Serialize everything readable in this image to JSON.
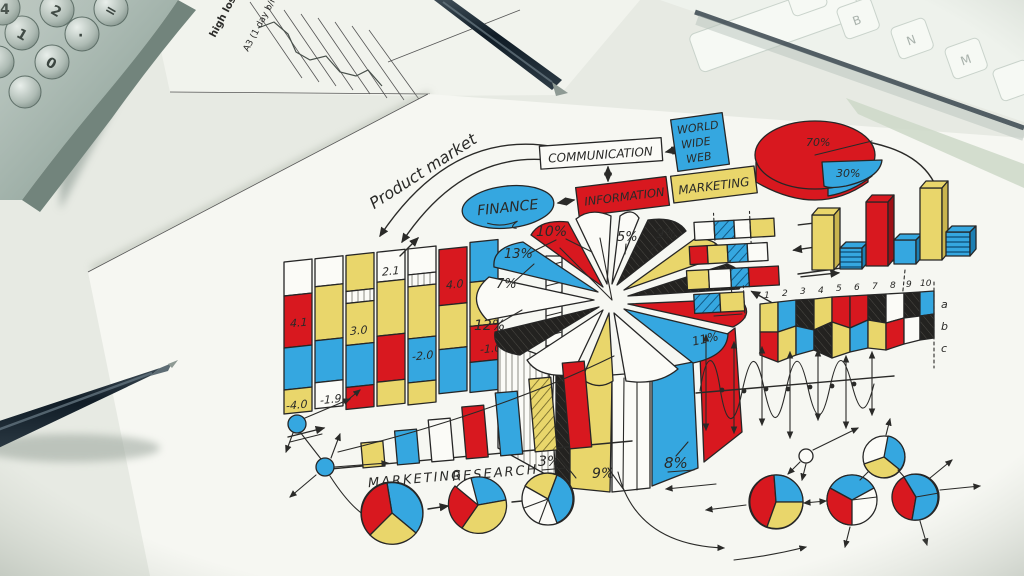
{
  "palette": {
    "red": "#d8181f",
    "blue": "#35a7e0",
    "yellow": "#e9d66b",
    "ink": "#2a2a28",
    "paper": "#f6f7f2"
  },
  "calculator": {
    "keys": [
      "0",
      "1",
      "2",
      "·",
      "=",
      "4"
    ]
  },
  "printed_sheet": {
    "note1": "high loss.",
    "note2": "A3 (1 day b/m)"
  },
  "keyboard": {
    "keys": [
      "B",
      "N",
      "M"
    ]
  },
  "flowchart": {
    "product_market": "Product market",
    "communication": "COMMUNICATION",
    "www_line1": "WORLD",
    "www_line2": "WIDE",
    "www_line3": "WEB",
    "finance": "FINANCE",
    "information": "INFORMATION",
    "marketing": "MARKETING"
  },
  "pie_3d_small": {
    "label_top": "70%",
    "label_bottom": "30%"
  },
  "big_pie": {
    "labels": [
      "10%",
      "5%",
      "9%",
      "7%",
      "6%",
      "11%",
      "8%",
      "9%",
      "3%",
      "12%",
      "7%",
      "13%"
    ]
  },
  "ribbon_chart": {
    "values": [
      "4.1",
      "2.1",
      "4.0",
      "3.0",
      "-2.0",
      "-1.0",
      "-4.0",
      "-1.9"
    ]
  },
  "mosaic_chart": {
    "ticks": [
      "1",
      "2",
      "3",
      "4",
      "5",
      "6",
      "7",
      "8",
      "9",
      "10"
    ],
    "side_labels": [
      "a",
      "b",
      "c"
    ]
  },
  "research_chart": {
    "caption_word1": "MARKETING",
    "caption_word2": "RESEARCH"
  }
}
